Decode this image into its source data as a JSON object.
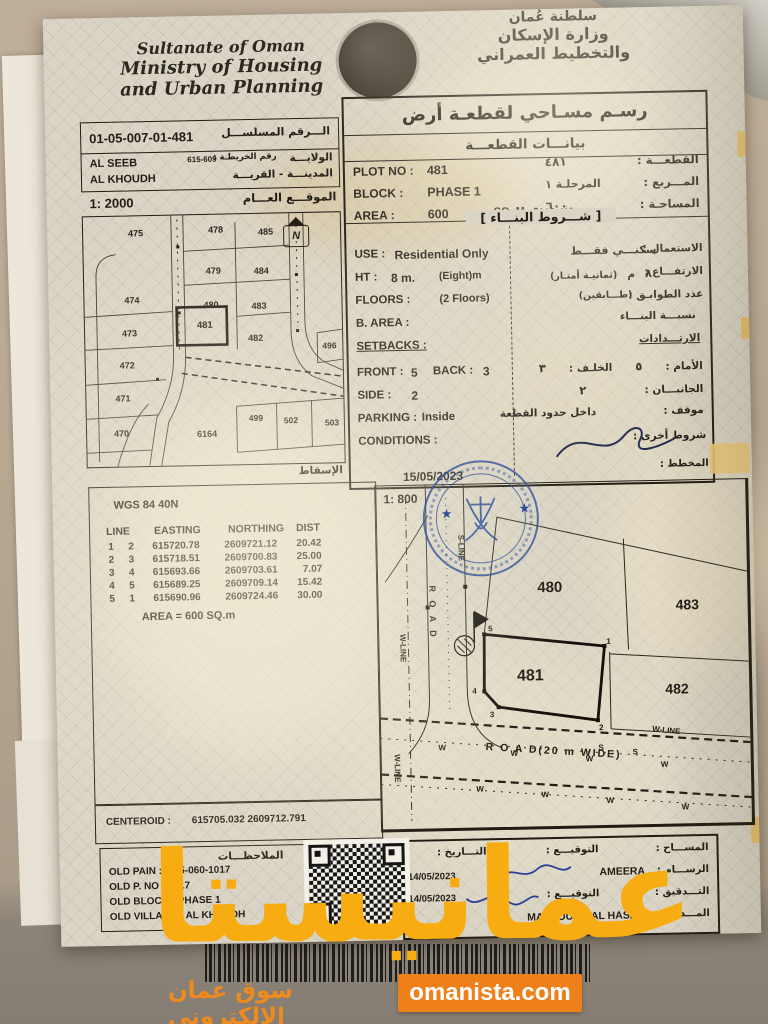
{
  "header": {
    "en_line1": "Sultanate of Oman",
    "en_line2": "Ministry of Housing",
    "en_line3": "and Urban Planning",
    "ar_line1": "سلطنة عُمان",
    "ar_line2": "وزارة الإسكان",
    "ar_line3": "والتخطيط العمراني"
  },
  "title": {
    "main": "رسـم مسـاحي لقطعـة أرض",
    "sub": "بيانـــات القطعـــة"
  },
  "serial": {
    "label": "الـــرقم المسلســـل",
    "value": "01-05-007-01-481",
    "map_no_label": "رقم الخريطـة :",
    "map_no": "615-609",
    "wilaya_label": "الولايـــة",
    "wilaya": "AL SEEB",
    "town_label": "المدينـــة - القريـــة",
    "town": "AL KHOUDH",
    "site_label": "الموقـــع العـــام",
    "scale": "1: 2000"
  },
  "plot": {
    "plot_no_label": "PLOT NO :",
    "plot_no": "481",
    "block_label": "BLOCK :",
    "block": "PHASE 1",
    "area_label": "AREA :",
    "area": "600",
    "area_unit": "SQ. M.",
    "ar_plot_label": "القطعـــة :",
    "ar_plot": "٤٨١",
    "ar_block_label": "المـــربع :",
    "ar_block": "المرحلـة ١",
    "ar_area_label": "المساحـة :",
    "ar_area": "٦٠٠",
    "ar_area_unit": "متر مربع",
    "conditions_header": "[ شـــروط البنـــاء ]"
  },
  "details": {
    "use_label": "USE :",
    "use": "Residential Only",
    "ar_use_label": "الاستعمال :",
    "ar_use": "سكنـــي فقـــط",
    "ht_label": "HT :",
    "ht": "8 m.",
    "ht_note": "(Eight)m",
    "ar_ht_label": "الارتفـــاع :",
    "ar_ht": "٨",
    "ar_ht_unit": "م",
    "ar_ht_note": "(ثمانيـة أمتـار)",
    "floors_label": "FLOORS :",
    "floors": "(2 Floors)",
    "ar_floors_label": "عدد الطوابـق :",
    "ar_floors_note": "(طـــابقين)",
    "barea_label": "B. AREA :",
    "ar_barea_label": "نسبـــة البنـــاء",
    "setbacks_label": "SETBACKS :",
    "ar_setbacks_label": "الارتـــدادات",
    "front_label": "FRONT :",
    "front": "5",
    "back_label": "BACK :",
    "back": "3",
    "ar_front_label": "الأمام :",
    "ar_front": "٥",
    "ar_back_label": "الخلـف :",
    "ar_back": "٣",
    "side_label": "SIDE :",
    "side": "2",
    "ar_side_label": "الجانبـــان :",
    "ar_side": "٢",
    "parking_label": "PARKING :",
    "parking": "Inside",
    "ar_parking_label": "موقف :",
    "ar_parking": "داخل حدود القطعة",
    "conditions_label": "CONDITIONS :",
    "ar_conditions_label": "شروط أخرى :",
    "date": "15/05/2023",
    "plan_label": "المخطط :"
  },
  "map2000": {
    "plots": [
      "475",
      "478",
      "485",
      "479",
      "484",
      "474",
      "480",
      "483",
      "473",
      "481",
      "482",
      "472",
      "471",
      "470",
      "6164",
      "499",
      "502",
      "503",
      "496"
    ],
    "north": "N",
    "projection_label": "الإسقاط"
  },
  "coords": {
    "datum": "WGS 84  40N",
    "col_line": "LINE",
    "col_easting": "EASTING",
    "col_northing": "NORTHING",
    "col_dist": "DIST",
    "rows": [
      [
        "1",
        "2",
        "615720.78",
        "2609721.12",
        "20.42"
      ],
      [
        "2",
        "3",
        "615718.51",
        "2609700.83",
        "25.00"
      ],
      [
        "3",
        "4",
        "615693.66",
        "2609703.61",
        "7.07"
      ],
      [
        "4",
        "5",
        "615689.25",
        "2609709.14",
        "15.42"
      ],
      [
        "5",
        "1",
        "615690.96",
        "2609724.46",
        "30.00"
      ]
    ],
    "area": "AREA = 600  SQ.m"
  },
  "map800": {
    "scale": "1: 800",
    "plots": [
      "480",
      "483",
      "481",
      "482"
    ],
    "corners": [
      "5",
      "1",
      "2",
      "3",
      "4"
    ],
    "road_v": "R O A D",
    "s_line": "S-LINE",
    "w_line": "W-LINE",
    "road_h": "R O A D(20 m WIDE)",
    "w": "W",
    "s": "S"
  },
  "centeroid": {
    "label": "CENTEROID :",
    "value": "615705.032 2609712.791"
  },
  "notes": {
    "title": "الملاحظـــات",
    "line1": "OLD PAIN : 1-35-060-1017",
    "line2": "OLD P. NO : 1017",
    "line3": "OLD BLOCK : PHASE 1",
    "line4": "OLD VILLAGE : AL KHOUDH"
  },
  "signatures": {
    "surveyor_label": "المســـاح :",
    "sign_label": "التوقيـــع :",
    "date_label": "التـــاريخ :",
    "draft_label": "الرســـام :",
    "draft_name": "AMEERA",
    "draft_date": "14/05/2023",
    "audit_label": "التـــدقيق :",
    "audit_date": "14/05/2023",
    "manager_label": "المـــدير :",
    "manager_name": "MAHFOUDH AL HASANI"
  },
  "watermark": {
    "big": "عمانيستا",
    "tagline": "سوق عمان الإلكتروني",
    "site": "omanista.com"
  },
  "colors": {
    "orange": "#ef8a1d",
    "amber": "#f6ac19",
    "stamp_blue": "#33539c",
    "ink_blue": "#2b3f94"
  }
}
